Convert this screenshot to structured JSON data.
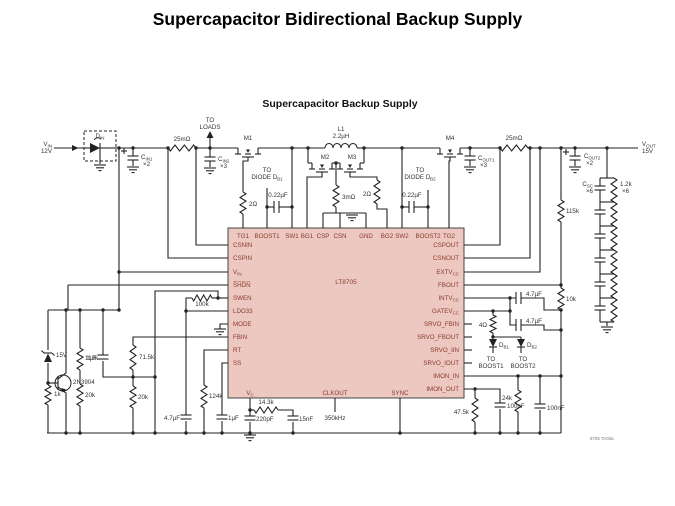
{
  "page": {
    "title": "Supercapacitor Bidirectional Backup Supply",
    "subtitle": "Supercapacitor Backup Supply",
    "part_code": "8705 TA03a"
  },
  "colors": {
    "chip_fill": "#ecc8c0",
    "chip_stroke": "#444444",
    "pin_text": "#8a3a2e",
    "wire": "#222222",
    "label": "#333333",
    "code_text": "#777777"
  },
  "chip": {
    "name": "LT8705",
    "pins": {
      "top": [
        {
          "t": "TG1",
          "x": 243
        },
        {
          "t": "BOOST1",
          "x": 267
        },
        {
          "t": "SW1",
          "x": 292
        },
        {
          "t": "BG1",
          "x": 307
        },
        {
          "t": "CSP",
          "x": 323
        },
        {
          "t": "CSN",
          "x": 340
        },
        {
          "t": "GND",
          "x": 366
        },
        {
          "t": "BG2",
          "x": 387
        },
        {
          "t": "SW2",
          "x": 402
        },
        {
          "t": "BOOST2",
          "x": 428
        },
        {
          "t": "TG2",
          "x": 449
        }
      ],
      "left": [
        {
          "t": "CSNIN",
          "y": 245
        },
        {
          "t": "CSPIN",
          "y": 258
        },
        {
          "t": "V",
          "sub": "IN",
          "y": 272
        },
        {
          "t": "S̅H̅D̅N̅",
          "y": 285
        },
        {
          "t": "SWEN",
          "y": 298
        },
        {
          "t": "LDO33",
          "y": 311
        },
        {
          "t": "MODE",
          "y": 324
        },
        {
          "t": "FBIN",
          "y": 337
        },
        {
          "t": "RT",
          "y": 350
        },
        {
          "t": "SS",
          "y": 363
        }
      ],
      "right": [
        {
          "t": "CSPOUT",
          "y": 245
        },
        {
          "t": "CSNOUT",
          "y": 258
        },
        {
          "t": "EXTV",
          "sub": "CC",
          "y": 272
        },
        {
          "t": "FBOUT",
          "y": 285
        },
        {
          "t": "INTV",
          "sub": "CC",
          "y": 298
        },
        {
          "t": "GATEV",
          "sub": "CC",
          "y": 311
        },
        {
          "t": "SRVO_FBIN",
          "y": 324
        },
        {
          "t": "SRVO_FBOUT",
          "y": 337
        },
        {
          "t": "SRVO_IIN",
          "y": 350
        },
        {
          "t": "SRVO_IOUT",
          "y": 363
        },
        {
          "t": "IMON_IN",
          "y": 376
        },
        {
          "t": "IMON_OUT",
          "y": 389
        }
      ],
      "bottom": [
        {
          "t": "V",
          "sub": "C",
          "x": 250
        },
        {
          "t": "CLKOUT",
          "x": 335
        },
        {
          "t": "SYNC",
          "x": 400
        }
      ]
    }
  },
  "labels": [
    {
      "x": 52,
      "y": 146,
      "t": "V",
      "sub": "IN",
      "a": "end"
    },
    {
      "x": 52,
      "y": 153,
      "t": "12V",
      "a": "end"
    },
    {
      "x": 100,
      "y": 138,
      "t": "D",
      "sub": "IN",
      "a": "middle"
    },
    {
      "x": 141,
      "y": 159,
      "t": "C",
      "sub": "IN1"
    },
    {
      "x": 143,
      "y": 166,
      "t": "×2"
    },
    {
      "x": 182,
      "y": 141,
      "t": "25mΩ",
      "a": "middle"
    },
    {
      "x": 210,
      "y": 122,
      "t": "TO",
      "a": "middle"
    },
    {
      "x": 210,
      "y": 129,
      "t": "LOADS",
      "a": "middle"
    },
    {
      "x": 218,
      "y": 161,
      "t": "C",
      "sub": "IN2"
    },
    {
      "x": 220,
      "y": 168,
      "t": "×3"
    },
    {
      "x": 248,
      "y": 140,
      "t": "M1",
      "a": "middle"
    },
    {
      "x": 249,
      "y": 206,
      "t": "2Ω"
    },
    {
      "x": 267,
      "y": 172,
      "t": "TO",
      "a": "middle"
    },
    {
      "x": 267,
      "y": 179,
      "t": "DIODE D",
      "sub": "B1",
      "a": "middle"
    },
    {
      "x": 278,
      "y": 197,
      "t": "0.22µF",
      "a": "middle"
    },
    {
      "x": 341,
      "y": 131,
      "t": "L1",
      "a": "middle"
    },
    {
      "x": 341,
      "y": 138,
      "t": "2.2µH",
      "a": "middle"
    },
    {
      "x": 325,
      "y": 159,
      "t": "M2",
      "a": "middle"
    },
    {
      "x": 352,
      "y": 159,
      "t": "M3",
      "a": "middle"
    },
    {
      "x": 342,
      "y": 199,
      "t": "3mΩ"
    },
    {
      "x": 371,
      "y": 196,
      "t": "2Ω",
      "a": "end"
    },
    {
      "x": 420,
      "y": 172,
      "t": "TO",
      "a": "middle"
    },
    {
      "x": 420,
      "y": 179,
      "t": "DIODE D",
      "sub": "B2",
      "a": "middle"
    },
    {
      "x": 412,
      "y": 197,
      "t": "0.22µF",
      "a": "middle"
    },
    {
      "x": 450,
      "y": 140,
      "t": "M4",
      "a": "middle"
    },
    {
      "x": 478,
      "y": 160,
      "t": "C",
      "sub": "OUT1"
    },
    {
      "x": 480,
      "y": 167,
      "t": "×3"
    },
    {
      "x": 514,
      "y": 140,
      "t": "25mΩ",
      "a": "middle"
    },
    {
      "x": 642,
      "y": 146,
      "t": "V",
      "sub": "OUT"
    },
    {
      "x": 642,
      "y": 153,
      "t": "15V"
    },
    {
      "x": 584,
      "y": 158,
      "t": "C",
      "sub": "OUT2"
    },
    {
      "x": 586,
      "y": 165,
      "t": "×2"
    },
    {
      "x": 593,
      "y": 186,
      "t": "C",
      "sub": "SC",
      "a": "end"
    },
    {
      "x": 593,
      "y": 193,
      "t": "×6",
      "a": "end"
    },
    {
      "x": 620,
      "y": 186,
      "t": "1.2k"
    },
    {
      "x": 622,
      "y": 193,
      "t": "×6"
    },
    {
      "x": 566,
      "y": 213,
      "t": "115k"
    },
    {
      "x": 566,
      "y": 301,
      "t": "10k"
    },
    {
      "x": 526,
      "y": 296,
      "t": "4.7µF"
    },
    {
      "x": 526,
      "y": 323,
      "t": "4.7µF"
    },
    {
      "x": 487,
      "y": 327,
      "t": "4Ω",
      "a": "end"
    },
    {
      "x": 499,
      "y": 347,
      "t": "D",
      "sub": "B1"
    },
    {
      "x": 527,
      "y": 347,
      "t": "D",
      "sub": "B2"
    },
    {
      "x": 491,
      "y": 361,
      "t": "TO",
      "a": "middle"
    },
    {
      "x": 491,
      "y": 368,
      "t": "BOOST1",
      "a": "middle"
    },
    {
      "x": 523,
      "y": 361,
      "t": "TO",
      "a": "middle"
    },
    {
      "x": 523,
      "y": 368,
      "t": "BOOST2",
      "a": "middle"
    },
    {
      "x": 512,
      "y": 400,
      "t": "24k",
      "a": "end"
    },
    {
      "x": 547,
      "y": 410,
      "t": "100nF"
    },
    {
      "x": 469,
      "y": 414,
      "t": "47.5k",
      "a": "end"
    },
    {
      "x": 507,
      "y": 408,
      "t": "100nF"
    },
    {
      "x": 202,
      "y": 306,
      "t": "100k",
      "a": "middle"
    },
    {
      "x": 56,
      "y": 357,
      "t": "15V"
    },
    {
      "x": 85,
      "y": 360,
      "t": "113k"
    },
    {
      "x": 97,
      "y": 360,
      "t": "1µF",
      "a": "end"
    },
    {
      "x": 139,
      "y": 359,
      "t": "71.5k"
    },
    {
      "x": 73,
      "y": 384,
      "t": "2N3904"
    },
    {
      "x": 54,
      "y": 396,
      "t": "1k"
    },
    {
      "x": 85,
      "y": 397,
      "t": "20k"
    },
    {
      "x": 138,
      "y": 399,
      "t": "20k"
    },
    {
      "x": 209,
      "y": 398,
      "t": "124k"
    },
    {
      "x": 180,
      "y": 420,
      "t": "4.7µF",
      "a": "end"
    },
    {
      "x": 228,
      "y": 420,
      "t": "1µF"
    },
    {
      "x": 266,
      "y": 404,
      "t": "14.3k",
      "a": "middle"
    },
    {
      "x": 256,
      "y": 421,
      "t": "220pF"
    },
    {
      "x": 299,
      "y": 421,
      "t": "15nF"
    },
    {
      "x": 335,
      "y": 420,
      "t": "350kHz",
      "a": "middle"
    },
    {
      "x": 590,
      "y": 440,
      "t": "8705 TA03a",
      "fs": 4.4,
      "col": "#777777"
    }
  ]
}
